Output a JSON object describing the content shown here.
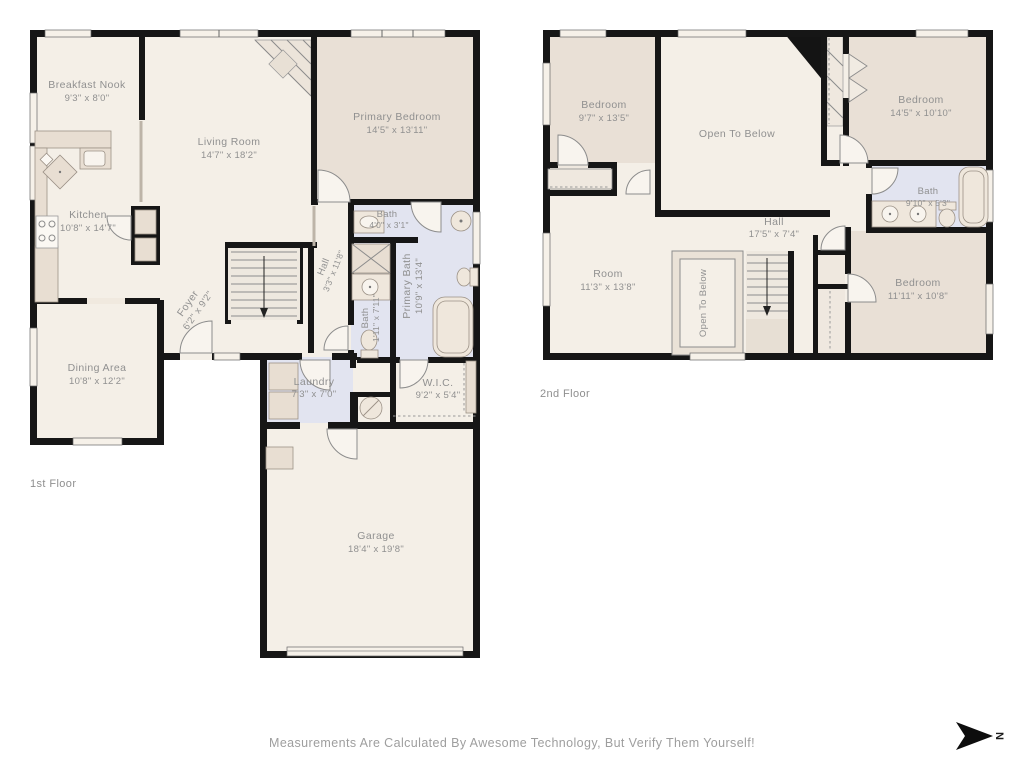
{
  "page": {
    "footer_note": "Measurements Are Calculated By Awesome Technology, But Verify Them Yourself!",
    "compass_label": "N"
  },
  "colors": {
    "wall": "#161616",
    "floor": "#f4efe7",
    "carpet": "#e9e0d6",
    "bath": "#e2e4f0",
    "furniture": "#e8ded2",
    "label_text": "#909090"
  },
  "floor1": {
    "label": "1st Floor",
    "rooms": {
      "breakfast_nook": {
        "name": "Breakfast Nook",
        "dims": "9'3\" x 8'0\""
      },
      "living_room": {
        "name": "Living Room",
        "dims": "14'7\" x 18'2\""
      },
      "primary_bedroom": {
        "name": "Primary Bedroom",
        "dims": "14'5\" x 13'11\""
      },
      "kitchen": {
        "name": "Kitchen",
        "dims": "10'8\" x 14'7\""
      },
      "bath": {
        "name": "Bath",
        "dims": "4'0\" x 3'1\""
      },
      "hall": {
        "name": "Hall",
        "dims": "3'3\" x 11'8\""
      },
      "foyer": {
        "name": "Foyer",
        "dims": "6'2\" x 9'2\""
      },
      "bath2": {
        "name": "Bath",
        "dims": "1'11\" x 7'11\""
      },
      "primary_bath": {
        "name": "Primary Bath",
        "dims": "10'9\" x 13'4\""
      },
      "dining_area": {
        "name": "Dining Area",
        "dims": "10'8\" x 12'2\""
      },
      "laundry": {
        "name": "Laundry",
        "dims": "7'3\" x 7'0\""
      },
      "wic": {
        "name": "W.I.C.",
        "dims": "9'2\" x 5'4\""
      },
      "garage": {
        "name": "Garage",
        "dims": "18'4\" x 19'8\""
      }
    }
  },
  "floor2": {
    "label": "2nd Floor",
    "rooms": {
      "bedroom_tl": {
        "name": "Bedroom",
        "dims": "9'7\" x 13'5\""
      },
      "open_below": {
        "name": "Open To Below",
        "dims": ""
      },
      "bedroom_tr": {
        "name": "Bedroom",
        "dims": "14'5\" x 10'10\""
      },
      "bath": {
        "name": "Bath",
        "dims": "9'10\" x 5'3\""
      },
      "hall": {
        "name": "Hall",
        "dims": "17'5\" x 7'4\""
      },
      "room": {
        "name": "Room",
        "dims": "11'3\" x 13'8\""
      },
      "open_below_2": {
        "name": "Open To Below",
        "dims": ""
      },
      "bedroom_br": {
        "name": "Bedroom",
        "dims": "11'11\" x 10'8\""
      }
    }
  }
}
